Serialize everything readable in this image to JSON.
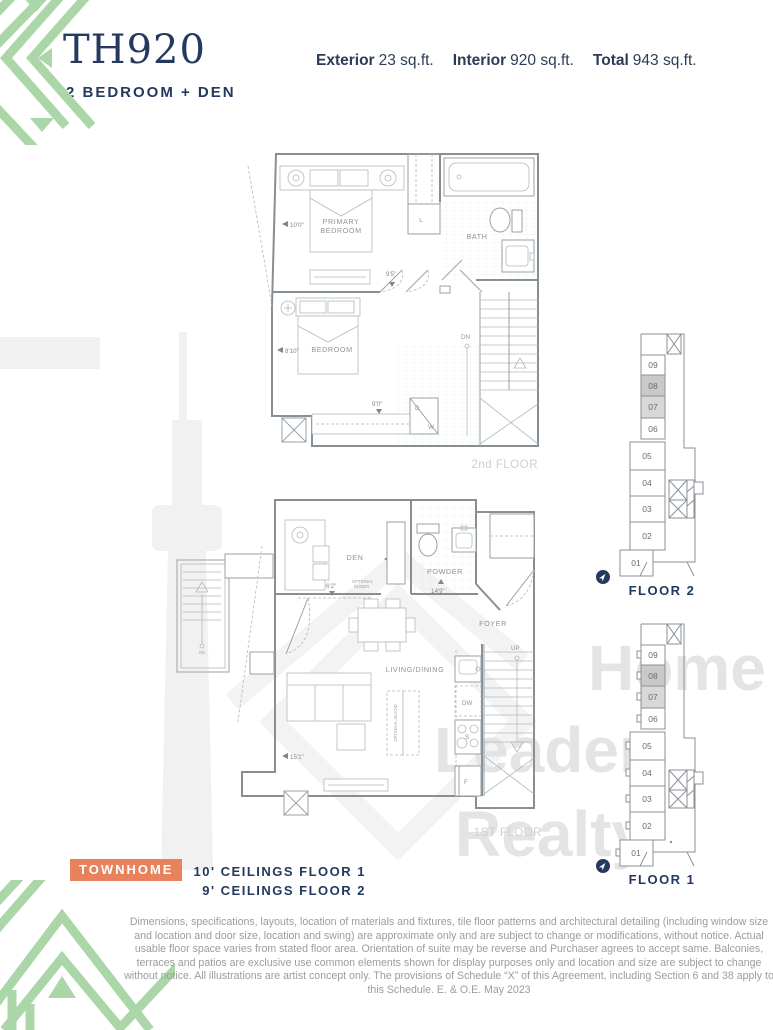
{
  "header": {
    "unit_id": "TH920",
    "unit_type": "2 BEDROOM + DEN",
    "stats": [
      {
        "label": "Exterior",
        "value": "23 sq.ft."
      },
      {
        "label": "Interior",
        "value": "920 sq.ft."
      },
      {
        "label": "Total",
        "value": "943 sq.ft."
      }
    ]
  },
  "watermark": {
    "line1": "Home",
    "line2": "Leader",
    "line3": "Realty"
  },
  "floor2": {
    "name": "2nd FLOOR",
    "rooms": {
      "primary1": "PRIMARY",
      "primary2": "BEDROOM",
      "bedroom": "BEDROOM",
      "bath": "BATH"
    },
    "fixtures": {
      "linen": "L",
      "dryer": "D",
      "washer": "W",
      "down": "DN"
    },
    "dims": {
      "primary_depth": "10'0\"",
      "hall": "9'5\"",
      "bedroom_depth": "8'10\"",
      "bedroom_width": "9'0\""
    }
  },
  "floor1": {
    "name": "1ST FLOOR",
    "rooms": {
      "den": "DEN",
      "powder": "POWDER",
      "foyer": "FOYER",
      "living": "LIVING/DINING"
    },
    "fixtures": {
      "up": "UP",
      "down": "DN",
      "dishwasher": "DW",
      "stove": "S",
      "fridge": "F",
      "optional_slider_1": "OPTIONAL",
      "optional_slider_2": "SLIDER",
      "optional_island": "OPTIONAL ISLAND"
    },
    "dims": {
      "den_opening": "6'2\"",
      "powder_width": "9'6\"",
      "main_width": "14'9\"",
      "living_width": "15'1\""
    }
  },
  "keyplans": [
    {
      "label": "FLOOR 2",
      "units": [
        "09",
        "08",
        "07",
        "06",
        "05",
        "04",
        "03",
        "02",
        "01"
      ],
      "highlighted": [
        "08",
        "07"
      ]
    },
    {
      "label": "FLOOR 1",
      "units": [
        "09",
        "08",
        "07",
        "06",
        "05",
        "04",
        "03",
        "02",
        "01"
      ],
      "highlighted": [
        "08",
        "07"
      ]
    }
  ],
  "footer": {
    "badge": "TOWNHOME",
    "ceiling_line1": "10' CEILINGS FLOOR 1",
    "ceiling_line2": "9' CEILINGS FLOOR 2",
    "disclaimer": "Dimensions, specifications, layouts, location of materials and fixtures, tile floor patterns and architectural detailing (including window size and location and door size, location and swing) are approximate only and are subject to change or modifications, without notice. Actual usable floor space varies from stated floor area. Orientation of suite may be reverse and Purchaser agrees to accept same. Balconies, terraces and patios are exclusive use common elements shown for display purposes only and location and size are subject to change without notice. All illustrations are artist concept only. The provisions of Schedule “X” of this Agreement, including Section 6 and 38 apply to this Schedule. E. & O.E. May 2023"
  },
  "colors": {
    "navy": "#24395e",
    "green": "#abd6a8",
    "orange": "#e8825c"
  }
}
